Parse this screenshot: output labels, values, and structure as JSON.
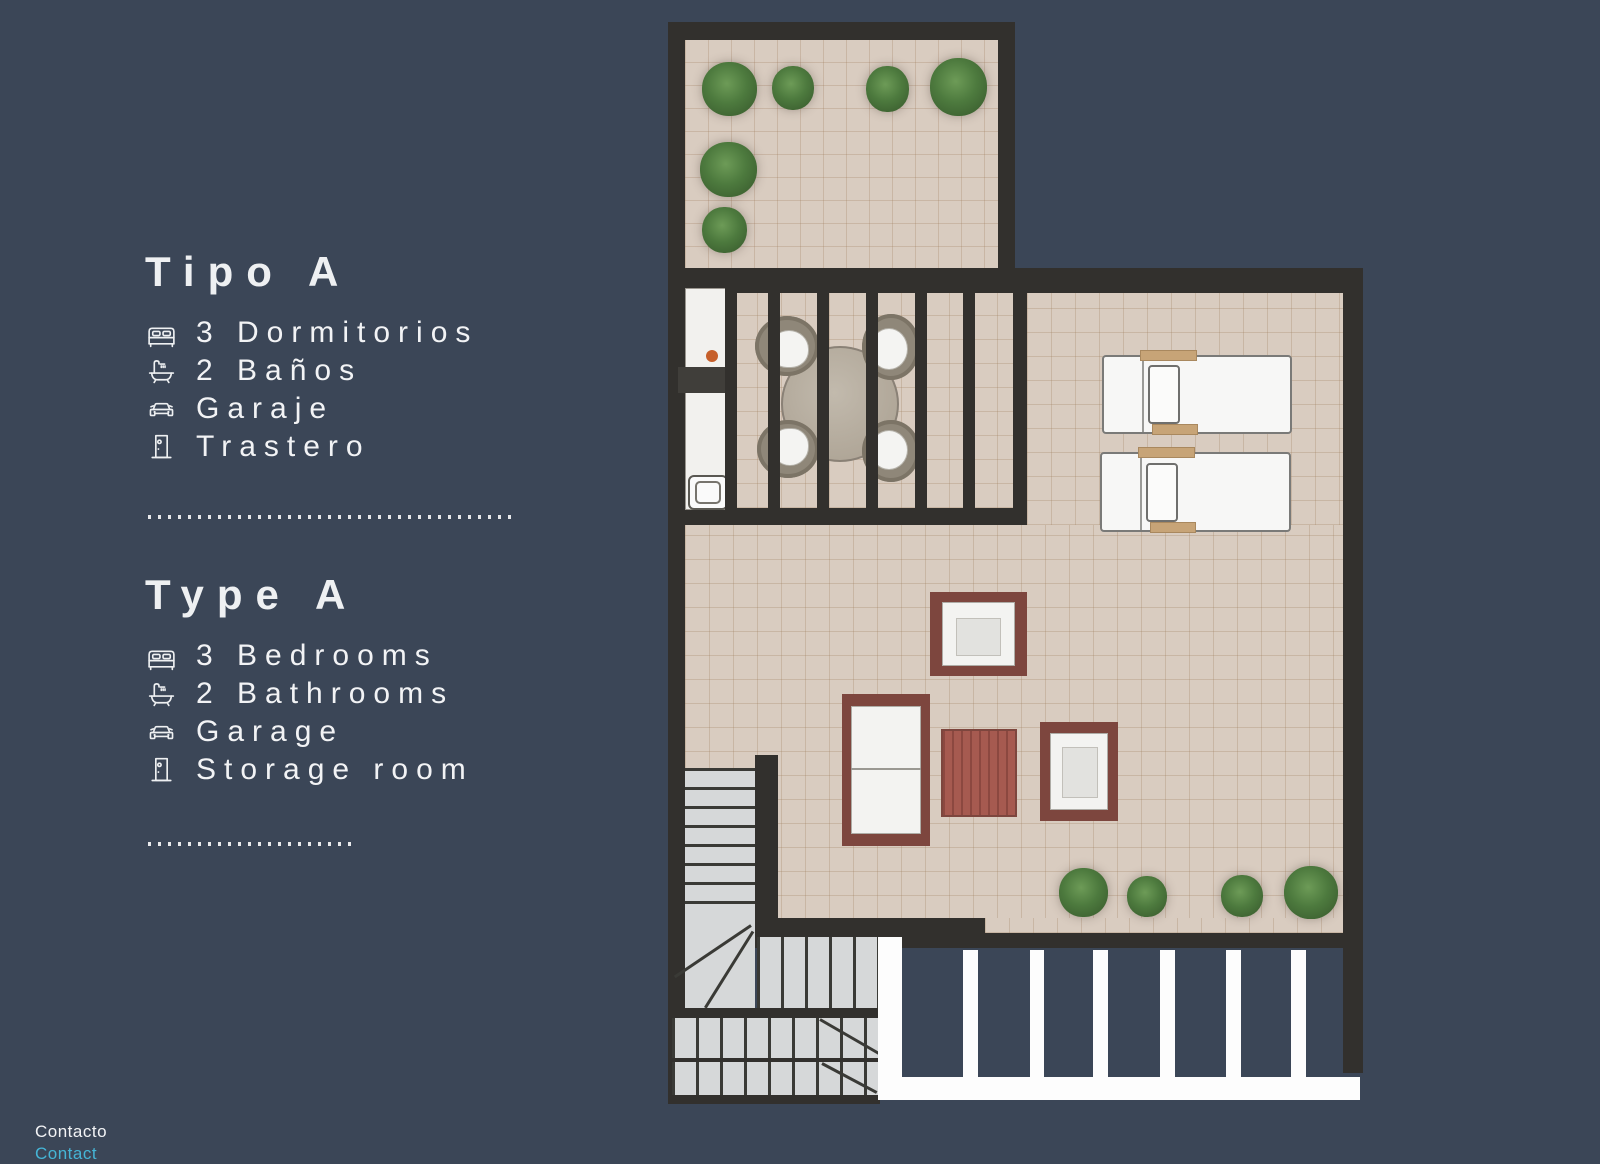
{
  "page": {
    "background": "#3b4657",
    "text_color": "#eef0f2",
    "accent_cyan": "#45b5d6"
  },
  "left_panel": {
    "section_es": {
      "title": "Tipo A",
      "items": [
        {
          "icon": "bed-icon",
          "label": "3 Dormitorios"
        },
        {
          "icon": "bath-icon",
          "label": "2 Baños"
        },
        {
          "icon": "car-icon",
          "label": "Garaje"
        },
        {
          "icon": "door-icon",
          "label": "Trastero"
        }
      ]
    },
    "section_en": {
      "title": "Type A",
      "items": [
        {
          "icon": "bed-icon",
          "label": "3 Bedrooms"
        },
        {
          "icon": "bath-icon",
          "label": "2 Bathrooms"
        },
        {
          "icon": "car-icon",
          "label": "Garage"
        },
        {
          "icon": "door-icon",
          "label": "Storage room"
        }
      ]
    }
  },
  "footer": {
    "contact_es": "Contacto",
    "contact_en": "Contact"
  },
  "floorplan": {
    "colors": {
      "wall": "#32302d",
      "floor_tile": "#d9ccc0",
      "stair_gray": "#d6d8d9",
      "furniture_frame_red": "#7d463e",
      "coffee_table_red": "#a65a50",
      "plant_green": "#4d7a3e",
      "kitchen_knob_orange": "#c65f2a",
      "patio_slat_white": "#ffffff"
    }
  }
}
